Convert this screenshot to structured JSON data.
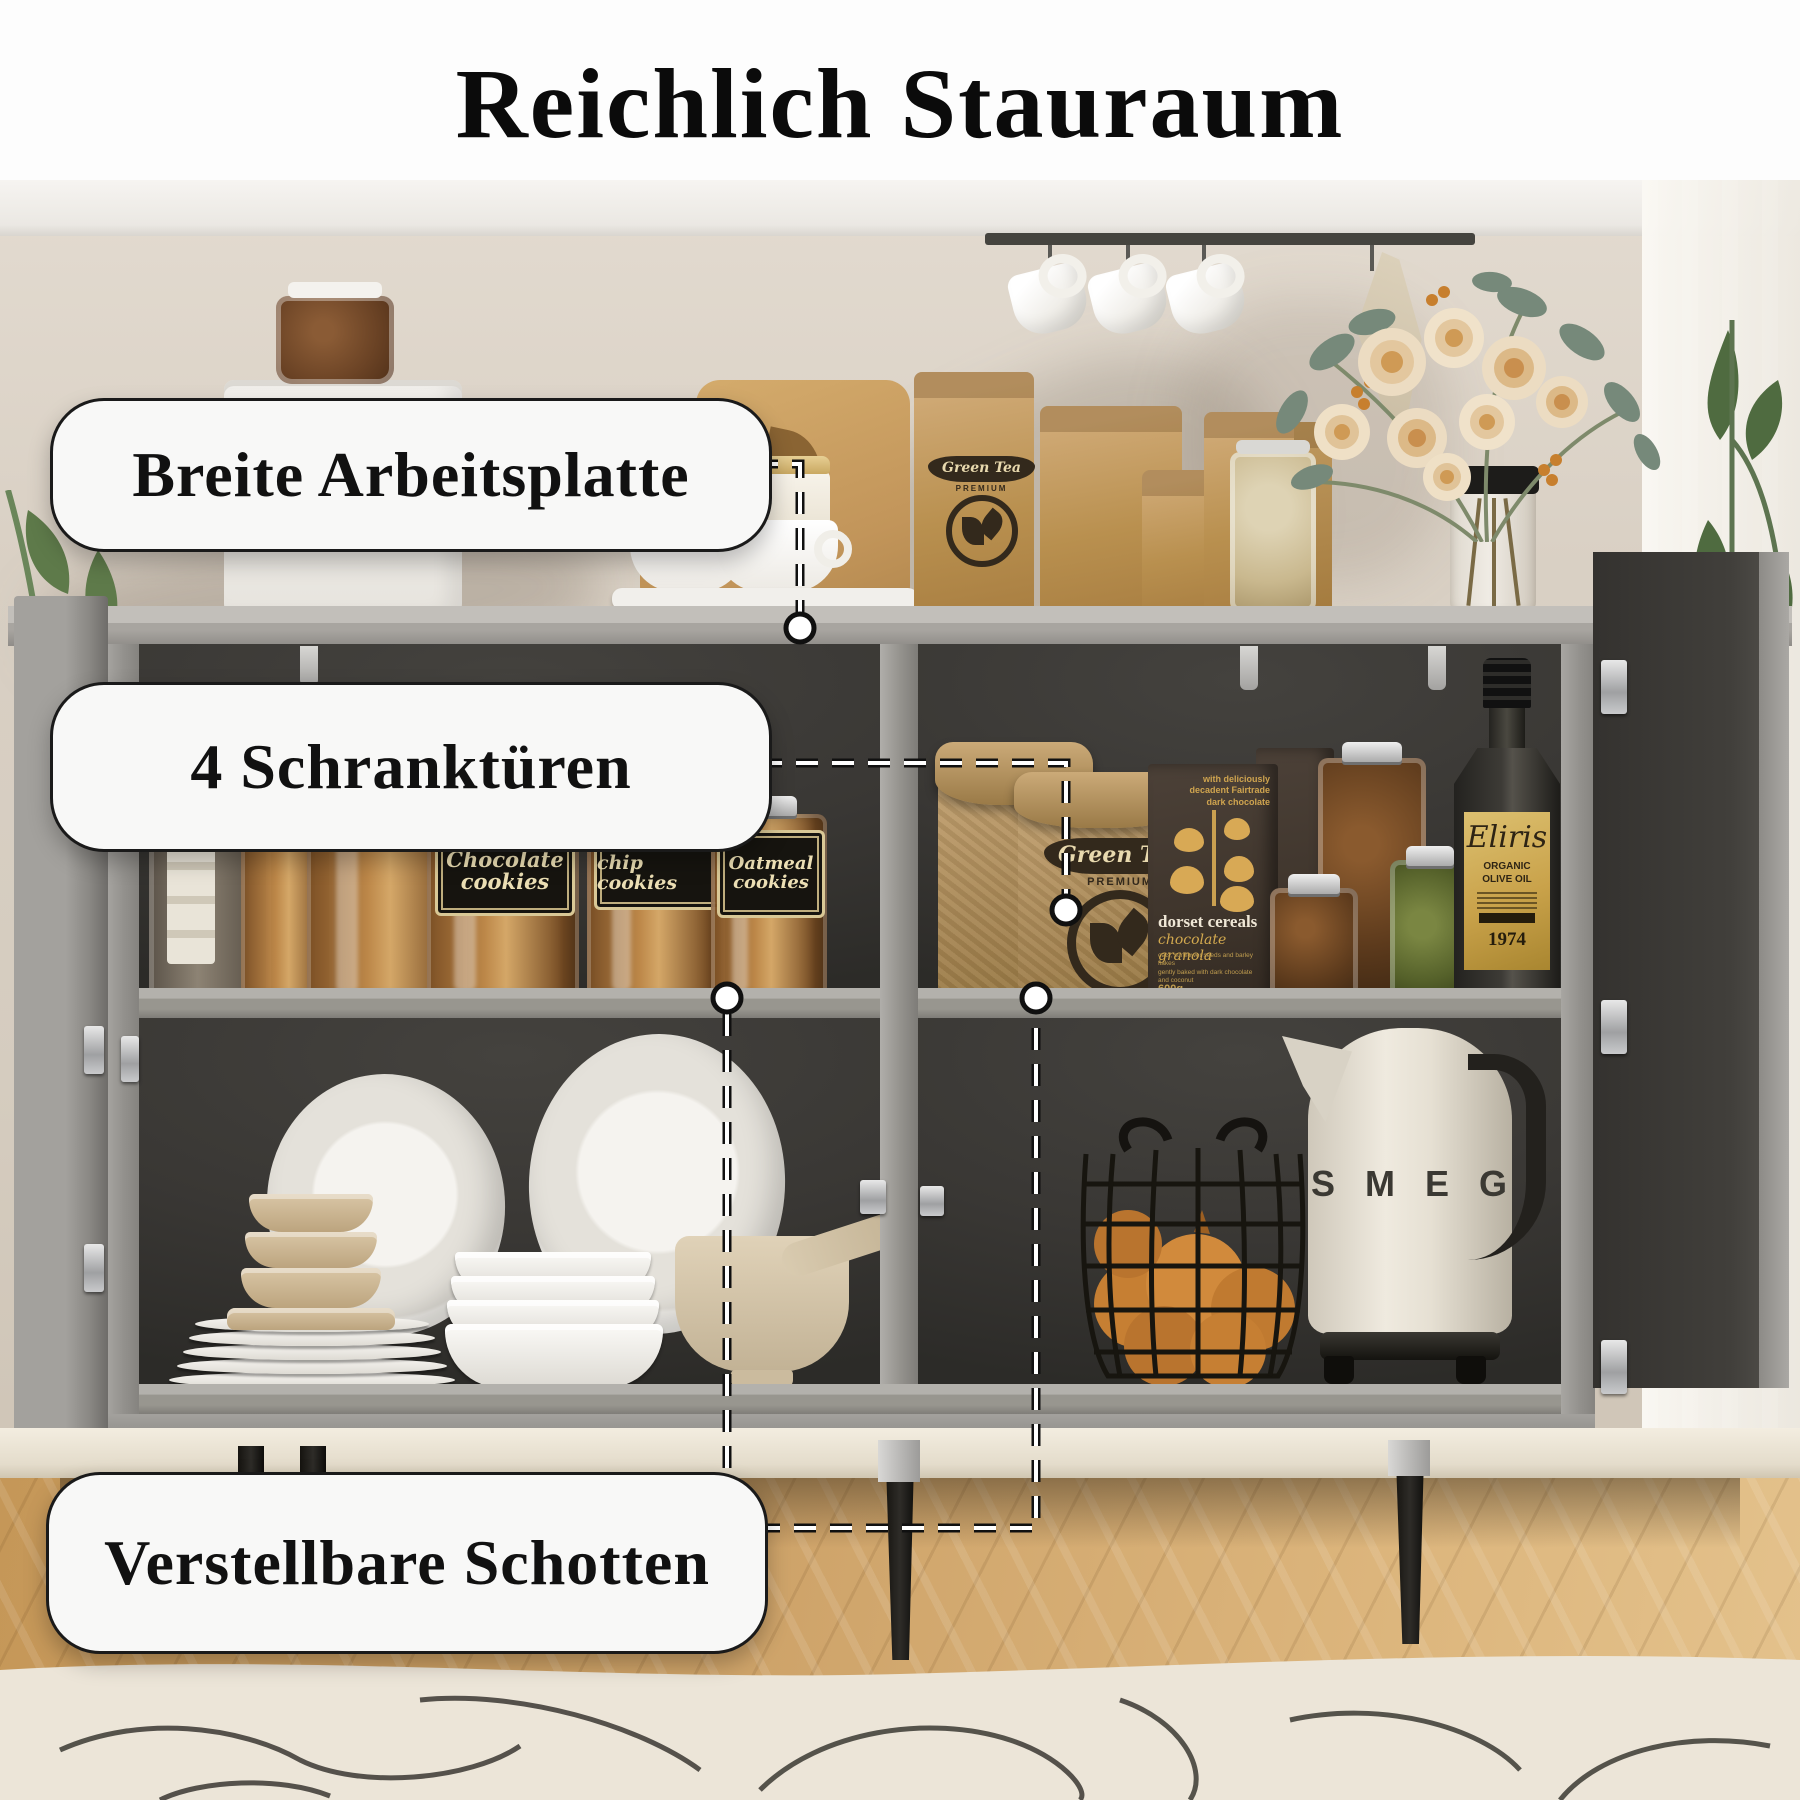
{
  "title": "Reichlich Stauraum",
  "annotations": {
    "worktop_label": "Breite Arbeitsplatte",
    "doors_label": "4 Schranktüren",
    "shelves_label": "Verstellbare Schotten"
  },
  "products": {
    "cookie_jar_1": {
      "line1": "Chocolate",
      "line2": "cookies"
    },
    "cookie_jar_2": {
      "line1": "Chocolate",
      "line2": "chip cookies"
    },
    "cookie_jar_3": {
      "line1": "Oatmeal",
      "line2": "cookies"
    },
    "green_tea": {
      "brand": "Green Tea",
      "grade": "PREMIUM"
    },
    "cereal": {
      "claim_line1": "with deliciously",
      "claim_line2": "decadent Fairtrade",
      "claim_line3": "dark chocolate",
      "brand": "dorset cereals",
      "variant": "chocolate granola",
      "desc_line1": "oats, sunflower seeds and barley flakes",
      "desc_line2": "gently baked with dark chocolate",
      "desc_line3": "and coconut",
      "weight": "600g"
    },
    "olive_oil": {
      "brand": "Eliris",
      "type_line1": "ORGANIC",
      "type_line2": "OLIVE OIL",
      "year": "1974"
    },
    "kettle_brand": "SMEG",
    "pasta_bag_text": "PASTA"
  },
  "colors": {
    "background": "#ffffff",
    "wall": "#d9d0c4",
    "cabinet_gray": "#97958f",
    "interior_dark": "#393734",
    "label_box_bg": "#f8f8f7",
    "label_box_border": "#1a1a1a",
    "gold_label": "#c9a24a",
    "wood_floor": "#c99f63"
  }
}
